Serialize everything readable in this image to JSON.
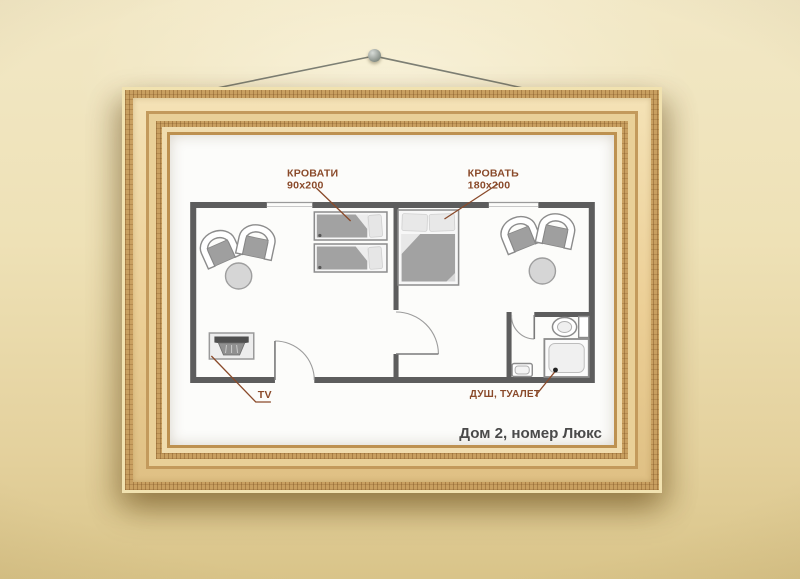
{
  "frame": {
    "caption": "Дом 2, номер Люкс"
  },
  "plan": {
    "annotations": {
      "twin_beds": {
        "title": "КРОВАТИ",
        "size": "90x200"
      },
      "double_bed": {
        "title": "КРОВАТЬ",
        "size": "180x200"
      },
      "tv": "TV",
      "bathroom": "ДУШ, ТУАЛЕТ"
    },
    "icons": {
      "armchair-icon": "top-view armchair with dark seat",
      "round-table-icon": "round side table",
      "single-bed-icon": "single bed 90x200 with pillow and blanket",
      "double-bed-icon": "double bed 180x200 with two pillows",
      "tv-icon": "TV set on stand, top view",
      "toilet-icon": "toilet with cistern",
      "shower-icon": "shower tray with drain dot",
      "sink-icon": "washbasin",
      "door-icon": "door leaf with swing arc",
      "window-icon": "window gap in wall",
      "nail-icon": "wall nail",
      "wire-icon": "picture hanging wire"
    }
  },
  "colors": {
    "wall_paint": "#ecdfb4",
    "frame_gold_light": "#f0dcae",
    "frame_gold_dark": "#c89f60",
    "plan_walls": "#5d5d5d",
    "annotation_text": "#8a4a2a",
    "caption_text": "#4a4a4a",
    "furniture_dark": "#a2a2a2",
    "furniture_light": "#e6e6e6"
  }
}
